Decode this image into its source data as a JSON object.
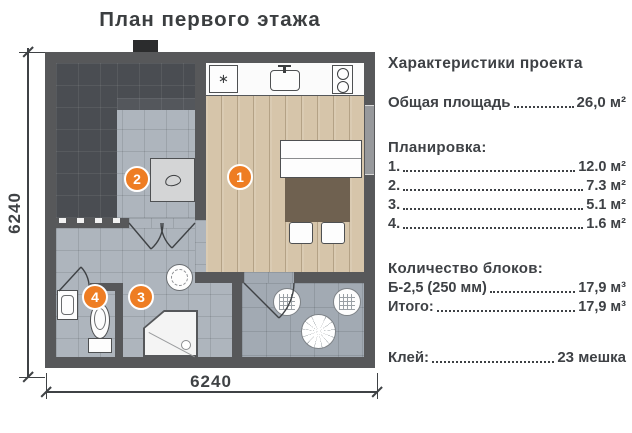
{
  "title": "План первого этажа",
  "dimensions": {
    "left": "6240",
    "bottom": "6240"
  },
  "plan": {
    "badges": [
      {
        "num": "1"
      },
      {
        "num": "2"
      },
      {
        "num": "3"
      },
      {
        "num": "4"
      }
    ]
  },
  "specs": {
    "heading": "Характеристики проекта",
    "total": {
      "label": "Общая площадь",
      "value": "26,0 м²"
    },
    "layout": {
      "heading": "Планировка:",
      "items": [
        {
          "label": "1.",
          "value": "12.0 м²"
        },
        {
          "label": "2.",
          "value": "7.3 м²"
        },
        {
          "label": "3.",
          "value": "5.1 м²"
        },
        {
          "label": "4.",
          "value": "1.6 м²"
        }
      ]
    },
    "blocks": {
      "heading": "Количество блоков:",
      "items": [
        {
          "label": "Б-2,5 (250 мм)",
          "value": "17,9 м³"
        },
        {
          "label": "Итого:",
          "value": "17,9 м³"
        }
      ]
    },
    "glue": {
      "label": "Клей:",
      "value": "23 мешка"
    }
  },
  "colors": {
    "accent_orange": "#ee7d23",
    "wall_gray": "#57585a",
    "dark_tile": "#4a4d52",
    "light_tile": "#aeb5bd",
    "wood_floor": "#d6c5aa",
    "text": "#3e4145"
  }
}
